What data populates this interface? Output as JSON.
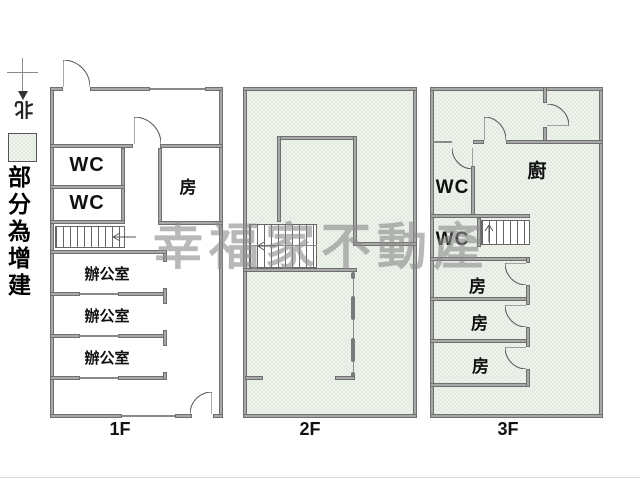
{
  "legend": {
    "north_label": "北",
    "caption": "部分為增建"
  },
  "watermark": {
    "text": "幸福家不動產"
  },
  "floor1": {
    "label": "1F",
    "wc_top": "WC",
    "wc_bottom": "WC",
    "room": "房",
    "office_top": "辦公室",
    "office_middle": "辦公室",
    "office_bottom": "辦公室"
  },
  "floor2": {
    "label": "2F"
  },
  "floor3": {
    "label": "3F",
    "kitchen": "廚",
    "wc_top": "WC",
    "wc_bottom": "WC",
    "room_top": "房",
    "room_middle": "房",
    "room_bottom": "房"
  },
  "colors": {
    "addition_fill": "#eef3ec",
    "wall": "#a8a8a8",
    "wall_edge": "#6f6f6f",
    "line": "#555555",
    "watermark": "#8e8e8e"
  }
}
